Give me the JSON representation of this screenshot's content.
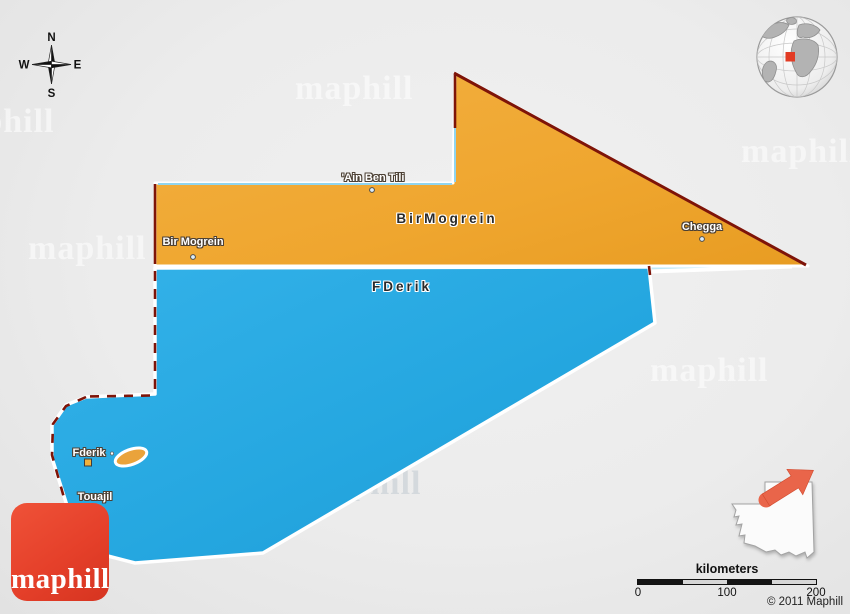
{
  "branding": {
    "logo_text": "maphill",
    "watermark_text": "maphill",
    "copyright": "© 2011 Maphill"
  },
  "compass": {
    "n": "N",
    "e": "E",
    "s": "S",
    "w": "W"
  },
  "map": {
    "title_context": "Political 3D map of Tiris Zemmour",
    "regions": [
      {
        "name": "BirMogrein",
        "color": "#efa62f"
      },
      {
        "name": "FDerik",
        "color": "#25a7e0"
      }
    ],
    "towns": [
      {
        "name": "'Ain Ben Tili"
      },
      {
        "name": "Bir Mogrein"
      },
      {
        "name": "Chegga"
      },
      {
        "name": "Fderik"
      },
      {
        "name": "Touajil"
      }
    ],
    "colors": {
      "boundary_red": "#7e1408",
      "boundary_lightblue": "#90d5ef",
      "background": "#ececec",
      "logo_red": "#e8432d",
      "inset_arrow": "#e9654a",
      "enclave_orange": "#eaa33b"
    }
  },
  "scale": {
    "title": "kilometers",
    "ticks": [
      "0",
      "100",
      "200"
    ]
  }
}
